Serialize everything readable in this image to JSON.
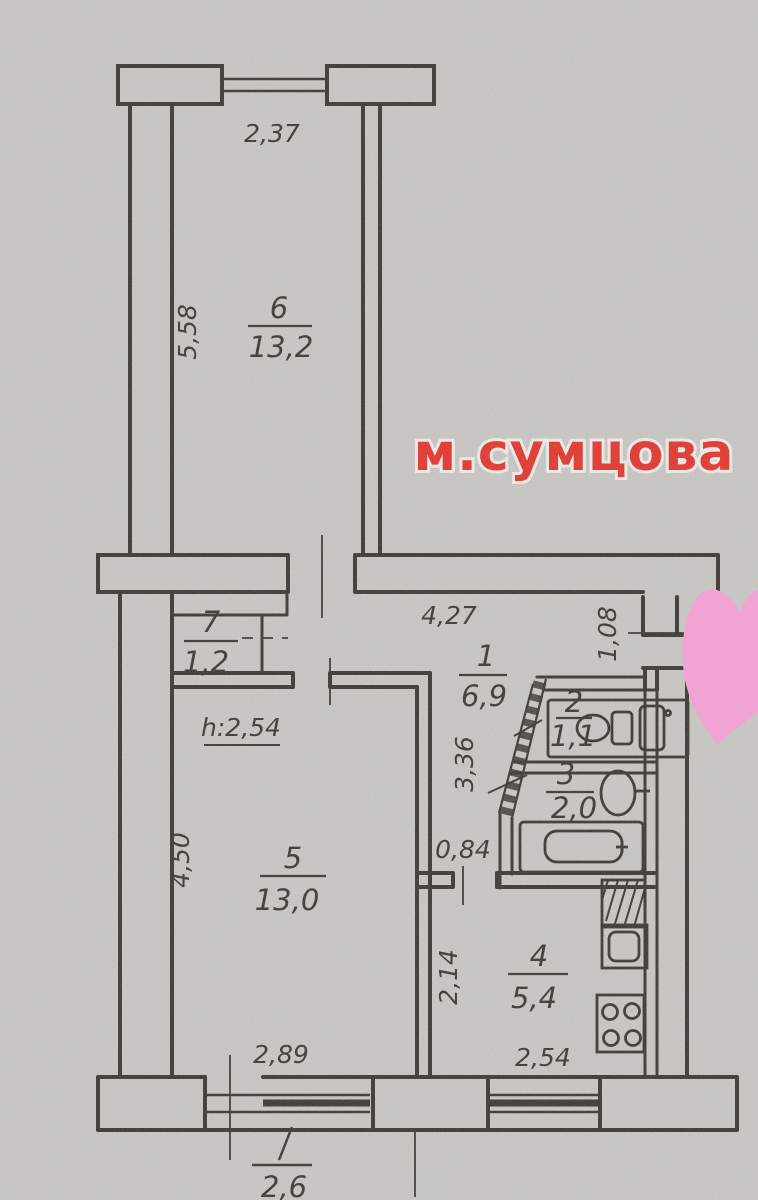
{
  "overlay": {
    "watermark": "м.сумцова",
    "heart_icon": "pink-heart"
  },
  "rooms": {
    "room6": {
      "number": "6",
      "area": "13,2"
    },
    "room7": {
      "number": "7",
      "area": "1,2"
    },
    "hall": {
      "number": "1",
      "area": "6,9"
    },
    "wc": {
      "number": "2",
      "area": "1,1"
    },
    "bathroom": {
      "number": "3",
      "area": "2,0"
    },
    "living": {
      "number": "5",
      "area": "13,0"
    },
    "kitchen": {
      "number": "4",
      "area": "5,4"
    },
    "balcony": {
      "area": "2,6"
    }
  },
  "dimensions": {
    "room6_window_width": "2,37",
    "room6_depth": "5,58",
    "hall_width": "4,27",
    "entry_width": "1,08",
    "bath_side": "3,36",
    "niche_width": "0,84",
    "living_depth": "4,50",
    "ceiling_height": "h:2,54",
    "kitchen_depth": "2,14",
    "living_width": "2,89",
    "kitchen_window_width": "2,54"
  },
  "icons": [
    "toilet-icon",
    "sink-icon",
    "bathtub-icon",
    "stove-icon",
    "vent-hatch-icon",
    "heart-icon"
  ],
  "colors": {
    "paper": "#c8c7c3",
    "ink": "#39352e",
    "watermark_red": "#e5322b",
    "heart_pink": "#f7a2d6"
  }
}
